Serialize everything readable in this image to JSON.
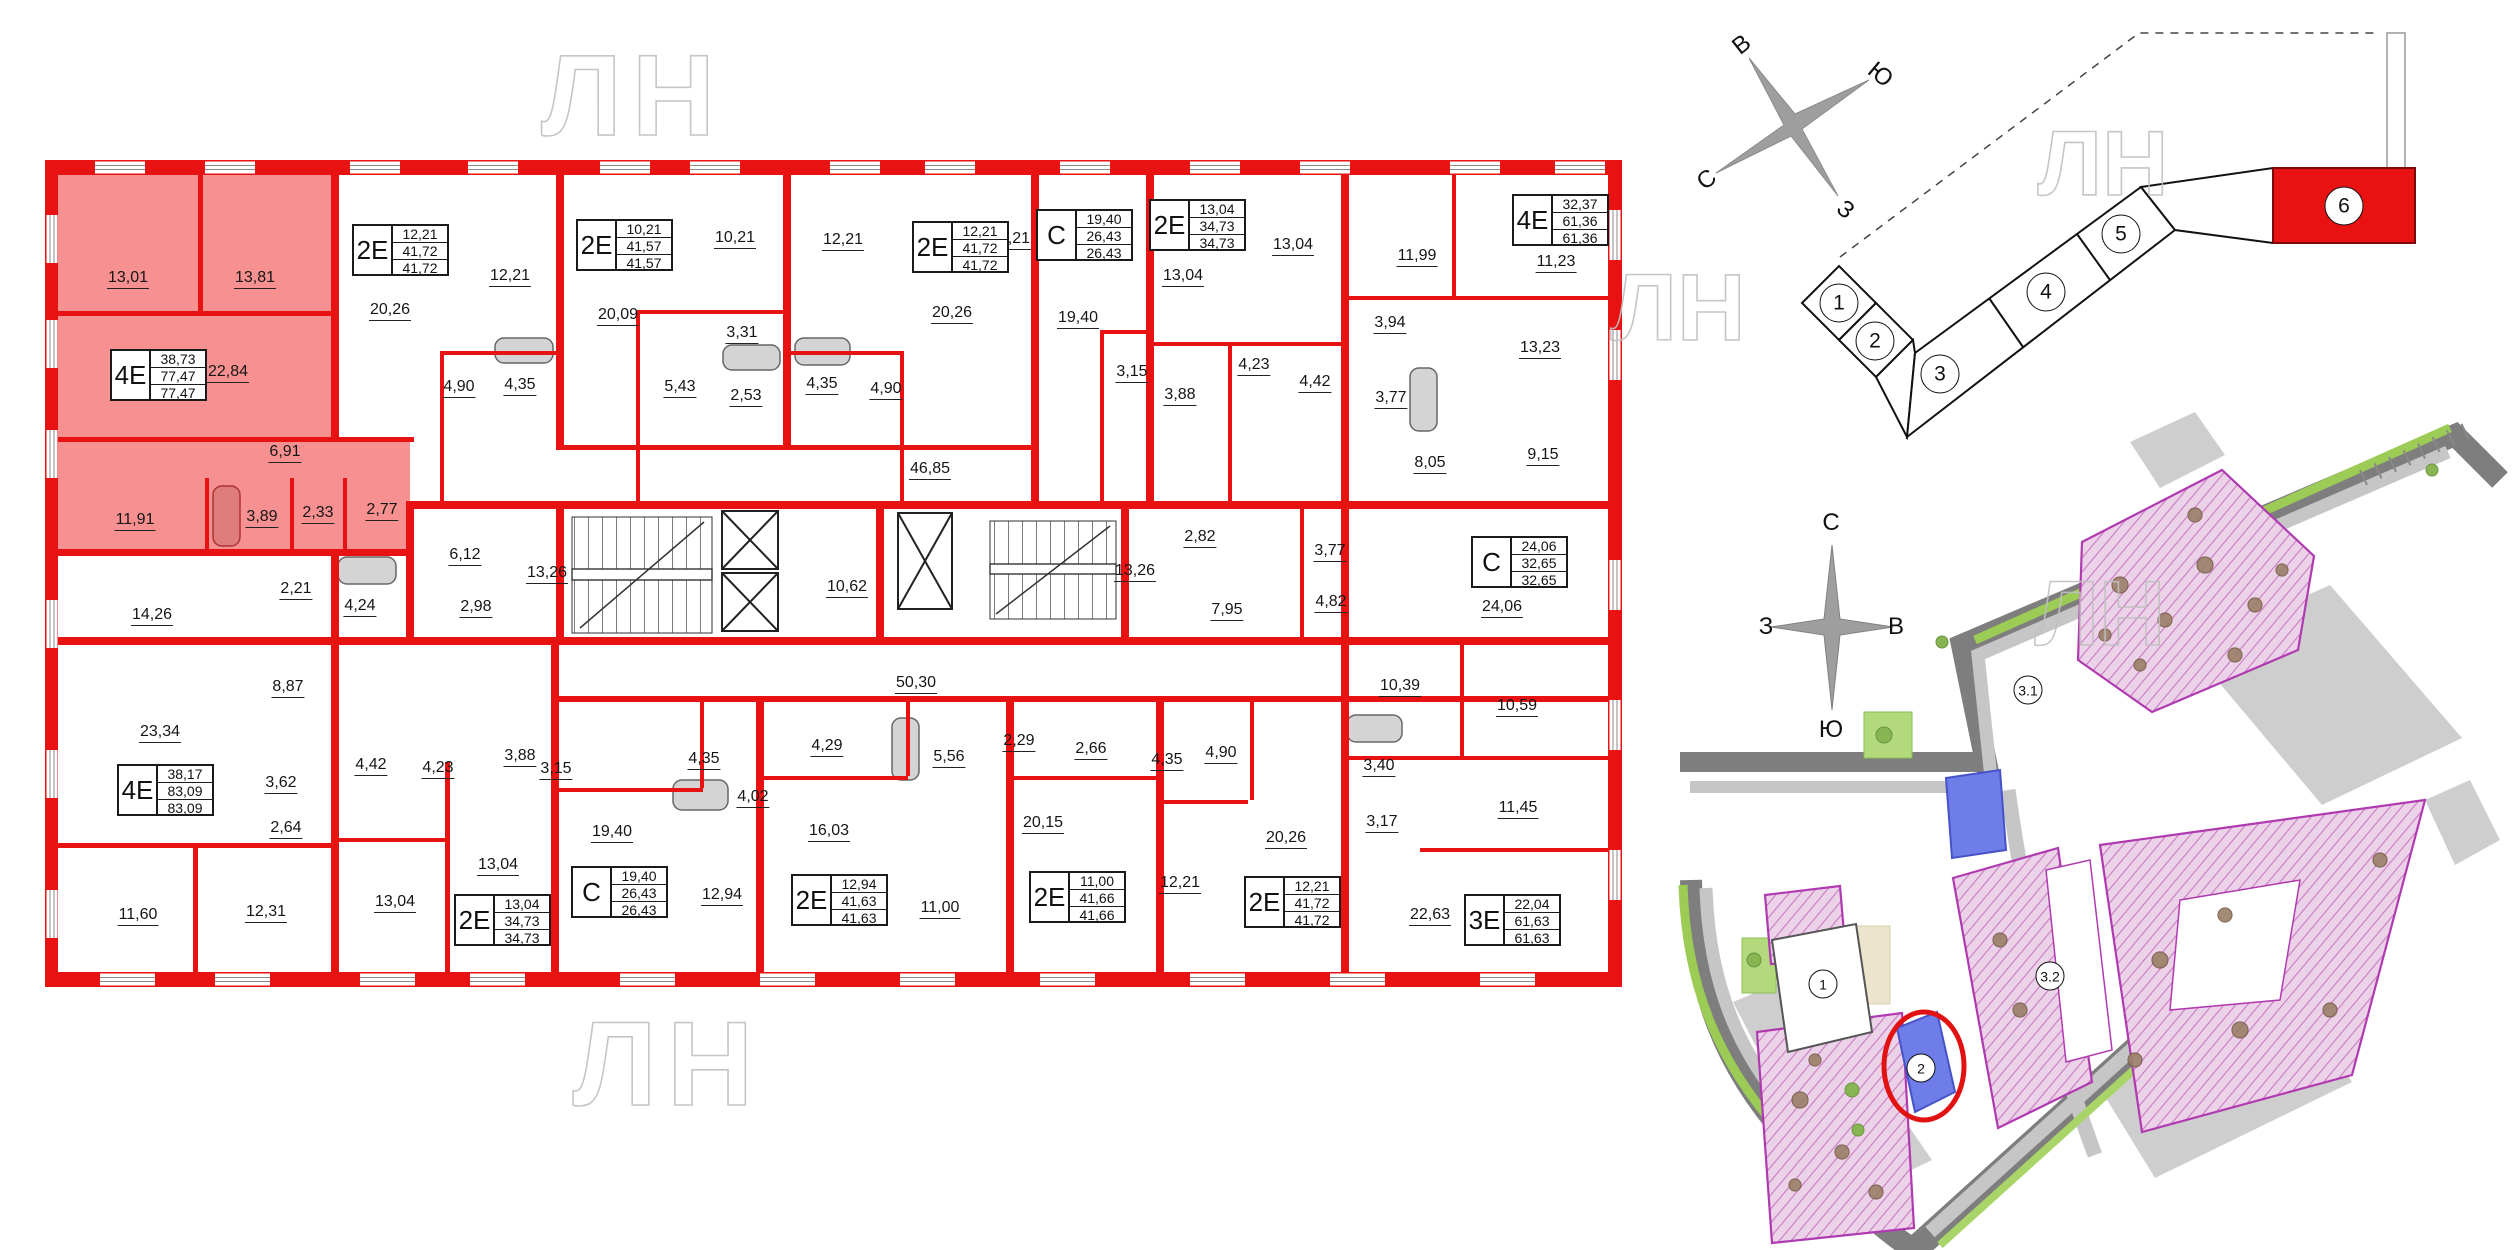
{
  "watermark_text": "ЛН",
  "colors": {
    "wall_red": "#e81212",
    "apartment_highlight": "#f79090",
    "site_purple_border": "#b03ab0",
    "site_blue_building": "#6f7de8",
    "highlight_section_red": "#e81212"
  },
  "floor_plan": {
    "apartments": [
      {
        "type": "4Е",
        "values": [
          "38,73",
          "77,47",
          "77,47"
        ],
        "x": 110,
        "y": 349
      },
      {
        "type": "2Е",
        "values": [
          "12,21",
          "41,72",
          "41,72"
        ],
        "x": 352,
        "y": 224
      },
      {
        "type": "2Е",
        "values": [
          "10,21",
          "41,57",
          "41,57"
        ],
        "x": 576,
        "y": 219
      },
      {
        "type": "2Е",
        "values": [
          "12,21",
          "41,72",
          "41,72"
        ],
        "x": 912,
        "y": 221
      },
      {
        "type": "С",
        "values": [
          "19,40",
          "26,43",
          "26,43"
        ],
        "x": 1036,
        "y": 209
      },
      {
        "type": "2Е",
        "values": [
          "13,04",
          "34,73",
          "34,73"
        ],
        "x": 1149,
        "y": 199
      },
      {
        "type": "4Е",
        "values": [
          "32,37",
          "61,36",
          "61,36"
        ],
        "x": 1512,
        "y": 194
      },
      {
        "type": "4Е",
        "values": [
          "38,17",
          "83,09",
          "83,09"
        ],
        "x": 117,
        "y": 764
      },
      {
        "type": "С",
        "values": [
          "24,06",
          "32,65",
          "32,65"
        ],
        "x": 1471,
        "y": 536
      },
      {
        "type": "С",
        "values": [
          "19,40",
          "26,43",
          "26,43"
        ],
        "x": 571,
        "y": 866
      },
      {
        "type": "2Е",
        "values": [
          "12,94",
          "41,63",
          "41,63"
        ],
        "x": 791,
        "y": 874
      },
      {
        "type": "2Е",
        "values": [
          "11,00",
          "41,66",
          "41,66"
        ],
        "x": 1029,
        "y": 871
      },
      {
        "type": "2Е",
        "values": [
          "12,21",
          "41,72",
          "41,72"
        ],
        "x": 1244,
        "y": 876
      },
      {
        "type": "3Е",
        "values": [
          "22,04",
          "61,63",
          "61,63"
        ],
        "x": 1464,
        "y": 894
      },
      {
        "type": "2Е",
        "values": [
          "13,04",
          "34,73",
          "34,73"
        ],
        "x": 454,
        "y": 894
      }
    ],
    "room_labels": [
      {
        "t": "13,01",
        "x": 128,
        "y": 278
      },
      {
        "t": "13,81",
        "x": 255,
        "y": 278
      },
      {
        "t": "22,84",
        "x": 228,
        "y": 372
      },
      {
        "t": "6,91",
        "x": 285,
        "y": 452
      },
      {
        "t": "11,91",
        "x": 135,
        "y": 520
      },
      {
        "t": "3,89",
        "x": 262,
        "y": 517
      },
      {
        "t": "2,33",
        "x": 318,
        "y": 513
      },
      {
        "t": "2,77",
        "x": 382,
        "y": 510
      },
      {
        "t": "20,26",
        "x": 390,
        "y": 310
      },
      {
        "t": "12,21",
        "x": 510,
        "y": 276
      },
      {
        "t": "4,90",
        "x": 459,
        "y": 387
      },
      {
        "t": "4,35",
        "x": 520,
        "y": 385
      },
      {
        "t": "20,09",
        "x": 618,
        "y": 315
      },
      {
        "t": "10,21",
        "x": 735,
        "y": 238
      },
      {
        "t": "3,31",
        "x": 742,
        "y": 333
      },
      {
        "t": "5,43",
        "x": 680,
        "y": 387
      },
      {
        "t": "2,53",
        "x": 746,
        "y": 396
      },
      {
        "t": "12,21",
        "x": 843,
        "y": 240
      },
      {
        "t": "4,35",
        "x": 822,
        "y": 384
      },
      {
        "t": "4,90",
        "x": 886,
        "y": 389
      },
      {
        "t": "20,26",
        "x": 952,
        "y": 313
      },
      {
        "t": "12,21",
        "x": 1010,
        "y": 239
      },
      {
        "t": "19,40",
        "x": 1078,
        "y": 318
      },
      {
        "t": "3,15",
        "x": 1132,
        "y": 372
      },
      {
        "t": "13,04",
        "x": 1183,
        "y": 276
      },
      {
        "t": "3,88",
        "x": 1180,
        "y": 395
      },
      {
        "t": "4,23",
        "x": 1254,
        "y": 365
      },
      {
        "t": "13,04",
        "x": 1293,
        "y": 245
      },
      {
        "t": "4,42",
        "x": 1315,
        "y": 382
      },
      {
        "t": "11,99",
        "x": 1417,
        "y": 256
      },
      {
        "t": "3,94",
        "x": 1390,
        "y": 323
      },
      {
        "t": "3,77",
        "x": 1391,
        "y": 398
      },
      {
        "t": "11,23",
        "x": 1556,
        "y": 262
      },
      {
        "t": "13,23",
        "x": 1540,
        "y": 348
      },
      {
        "t": "46,85",
        "x": 930,
        "y": 469
      },
      {
        "t": "8,05",
        "x": 1430,
        "y": 463
      },
      {
        "t": "9,15",
        "x": 1543,
        "y": 455
      },
      {
        "t": "14,26",
        "x": 152,
        "y": 615
      },
      {
        "t": "2,21",
        "x": 296,
        "y": 589
      },
      {
        "t": "4,24",
        "x": 360,
        "y": 606
      },
      {
        "t": "6,12",
        "x": 465,
        "y": 555
      },
      {
        "t": "2,98",
        "x": 476,
        "y": 607
      },
      {
        "t": "13,26",
        "x": 547,
        "y": 573
      },
      {
        "t": "10,62",
        "x": 847,
        "y": 587
      },
      {
        "t": "13,26",
        "x": 1135,
        "y": 571
      },
      {
        "t": "2,82",
        "x": 1200,
        "y": 537
      },
      {
        "t": "7,95",
        "x": 1227,
        "y": 610
      },
      {
        "t": "3,77",
        "x": 1330,
        "y": 551
      },
      {
        "t": "4,82",
        "x": 1331,
        "y": 602
      },
      {
        "t": "24,06",
        "x": 1502,
        "y": 607
      },
      {
        "t": "50,30",
        "x": 916,
        "y": 683
      },
      {
        "t": "8,87",
        "x": 288,
        "y": 687
      },
      {
        "t": "23,34",
        "x": 160,
        "y": 732
      },
      {
        "t": "3,62",
        "x": 281,
        "y": 783
      },
      {
        "t": "2,64",
        "x": 286,
        "y": 828
      },
      {
        "t": "4,42",
        "x": 371,
        "y": 765
      },
      {
        "t": "4,23",
        "x": 438,
        "y": 768
      },
      {
        "t": "3,88",
        "x": 520,
        "y": 756
      },
      {
        "t": "3,15",
        "x": 556,
        "y": 769
      },
      {
        "t": "11,60",
        "x": 138,
        "y": 915
      },
      {
        "t": "12,31",
        "x": 266,
        "y": 912
      },
      {
        "t": "13,04",
        "x": 395,
        "y": 902
      },
      {
        "t": "13,04",
        "x": 498,
        "y": 865
      },
      {
        "t": "19,40",
        "x": 612,
        "y": 832
      },
      {
        "t": "4,35",
        "x": 704,
        "y": 759
      },
      {
        "t": "4,02",
        "x": 753,
        "y": 797
      },
      {
        "t": "12,94",
        "x": 722,
        "y": 895
      },
      {
        "t": "4,29",
        "x": 827,
        "y": 746
      },
      {
        "t": "16,03",
        "x": 829,
        "y": 831
      },
      {
        "t": "5,56",
        "x": 949,
        "y": 757
      },
      {
        "t": "2,29",
        "x": 1019,
        "y": 741
      },
      {
        "t": "11,00",
        "x": 940,
        "y": 908
      },
      {
        "t": "2,66",
        "x": 1091,
        "y": 749
      },
      {
        "t": "20,15",
        "x": 1043,
        "y": 823
      },
      {
        "t": "4,35",
        "x": 1167,
        "y": 760
      },
      {
        "t": "4,90",
        "x": 1221,
        "y": 753
      },
      {
        "t": "12,21",
        "x": 1180,
        "y": 883
      },
      {
        "t": "20,26",
        "x": 1286,
        "y": 838
      },
      {
        "t": "3,40",
        "x": 1379,
        "y": 766
      },
      {
        "t": "3,17",
        "x": 1382,
        "y": 822
      },
      {
        "t": "10,39",
        "x": 1400,
        "y": 686
      },
      {
        "t": "10,59",
        "x": 1517,
        "y": 706
      },
      {
        "t": "11,45",
        "x": 1518,
        "y": 808
      },
      {
        "t": "22,63",
        "x": 1430,
        "y": 915
      }
    ]
  },
  "key_plan": {
    "compass": {
      "up_left": "В",
      "up_right": "Ю",
      "down_left": "С",
      "down_right": "З"
    },
    "sections": [
      {
        "label": "1"
      },
      {
        "label": "2"
      },
      {
        "label": "3"
      },
      {
        "label": "4"
      },
      {
        "label": "5"
      },
      {
        "label": "6",
        "highlighted": true
      }
    ],
    "highlighted_section": "6"
  },
  "site_plan": {
    "compass": {
      "north": "С",
      "east": "В",
      "west": "З",
      "south": "Ю"
    },
    "building_labels": [
      "1",
      "2",
      "3.1",
      "3.2"
    ],
    "circled_building": "2"
  }
}
